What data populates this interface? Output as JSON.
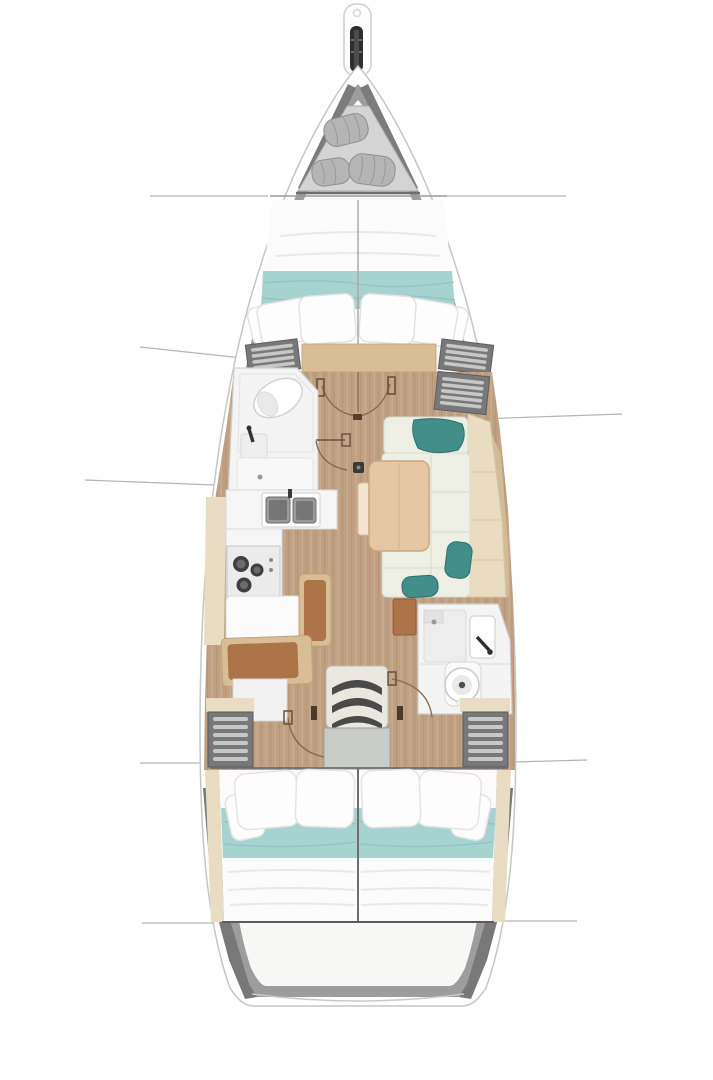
{
  "canvas": {
    "width": 713,
    "height": 1080,
    "background": "#ffffff"
  },
  "diagram": {
    "type": "boat-interior-floorplan",
    "subject": "sailing-yacht-layout-top-view",
    "palette": {
      "hull_rim": "#ffffff",
      "hull_stroke": "#c6c6c6",
      "hull_wall": "#9d9d9d",
      "hull_wall_dark": "#787878",
      "interior": "#f7f7f6",
      "floor_wood": "#c0a183",
      "floor_wood_light": "#d9bd96",
      "side_deck": "#e8ddc3",
      "bed_white": "#fbfbfb",
      "blanket_teal": "#a6d2d0",
      "pillow_teal": "#418e8a",
      "sofa_ivory": "#edeee4",
      "sofa_back_cream": "#e9dcc1",
      "table_wood": "#e6c7a4",
      "table_leaf": "#f2e4cf",
      "bench_brown": "#ad744a",
      "bench_frame": "#d9bd96",
      "locker_gray": "#787878",
      "engine_box": "#c9cbc9",
      "step_dark": "#4a4a4a",
      "fixture_white": "#f4f4f4",
      "sink_steel": "#8a8a8a",
      "sail_bag": "#b5b5b5",
      "anchor_dark": "#2e2e2e",
      "bow_panel": "#d4d4d4"
    },
    "areas": [
      {
        "id": "bowsprit",
        "label": "bowsprit-anchor-roller"
      },
      {
        "id": "bow-locker",
        "label": "bow-sail-locker"
      },
      {
        "id": "forward-cabin",
        "label": "forward-v-berth-cabin"
      },
      {
        "id": "forward-head",
        "label": "forward-head-toilet-sink"
      },
      {
        "id": "galley",
        "label": "galley-sinks-stove"
      },
      {
        "id": "port-settee",
        "label": "port-settee-bench"
      },
      {
        "id": "salon-dinette",
        "label": "salon-dinette-table-sofa"
      },
      {
        "id": "aft-head",
        "label": "aft-head-shower-sink-toilet"
      },
      {
        "id": "companionway",
        "label": "companionway-steps-engine-box"
      },
      {
        "id": "aft-cabin-port",
        "label": "aft-cabin-port-double-berth"
      },
      {
        "id": "aft-cabin-starboard",
        "label": "aft-cabin-starboard-double-berth"
      },
      {
        "id": "stern",
        "label": "stern-lazarette"
      }
    ]
  }
}
